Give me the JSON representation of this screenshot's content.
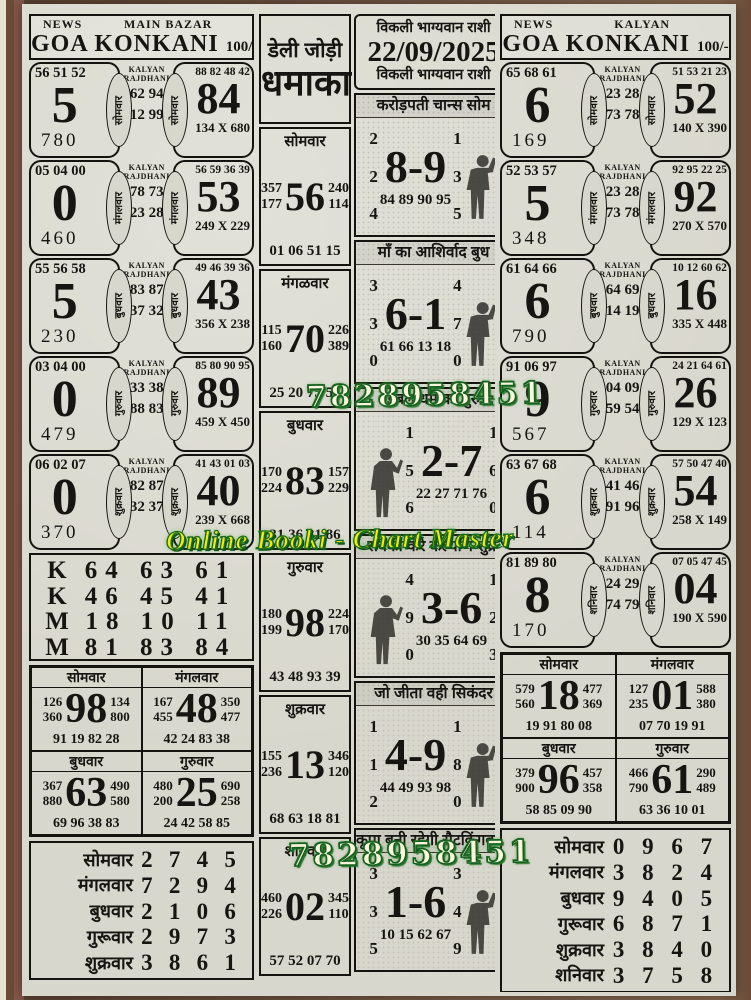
{
  "page": {
    "watermarks": {
      "phone": "7828958451",
      "brand": "Online Booki - Chart Master"
    },
    "left": {
      "header": {
        "news": "NEWS",
        "market": "MAIN BAZAR",
        "title": "GOA KONKANI",
        "price": "100/-"
      },
      "kalyan_label": "KALYAN RAJDHANI",
      "rows": [
        {
          "day": "सोमवार",
          "ltop": "56 51 52",
          "lbig": "5",
          "lbot": "780",
          "mid1": "62 94",
          "mid2": "12 99",
          "rtop": "88 82 48 42",
          "rbig": "84",
          "rbot": "134 X 680"
        },
        {
          "day": "मंगलवार",
          "ltop": "05 04 00",
          "lbig": "0",
          "lbot": "460",
          "mid1": "78 73",
          "mid2": "23 28",
          "rtop": "56 59 36 39",
          "rbig": "53",
          "rbot": "249 X 229"
        },
        {
          "day": "बुधवार",
          "ltop": "55 56 58",
          "lbig": "5",
          "lbot": "230",
          "mid1": "83 87",
          "mid2": "37 32",
          "rtop": "49 46 39 36",
          "rbig": "43",
          "rbot": "356 X 238"
        },
        {
          "day": "गुरुवार",
          "ltop": "03 04 00",
          "lbig": "0",
          "lbot": "479",
          "mid1": "33 38",
          "mid2": "88 83",
          "rtop": "85 80 90 95",
          "rbig": "89",
          "rbot": "459 X 450"
        },
        {
          "day": "शुक्रवार",
          "ltop": "06 02 07",
          "lbig": "0",
          "lbot": "370",
          "mid1": "82 87",
          "mid2": "32 37",
          "rtop": "41 43 01 03",
          "rbig": "40",
          "rbot": "239 X 668"
        }
      ],
      "km_lines": [
        {
          "label": "K",
          "nums": "64 63 61"
        },
        {
          "label": "K",
          "nums": "46 45 41"
        },
        {
          "label": "M",
          "nums": "18 10 11"
        },
        {
          "label": "M",
          "nums": "81 83 84"
        }
      ],
      "panels": [
        {
          "day": "सोमवार",
          "l1": "126",
          "l2": "360",
          "big": "98",
          "r1": "134",
          "r2": "800",
          "bottom": "91 19 82 28"
        },
        {
          "day": "मंगलवार",
          "l1": "167",
          "l2": "455",
          "big": "48",
          "r1": "350",
          "r2": "477",
          "bottom": "42 24 83 38"
        },
        {
          "day": "बुधवार",
          "l1": "367",
          "l2": "880",
          "big": "63",
          "r1": "490",
          "r2": "580",
          "bottom": "69 96 38 83"
        },
        {
          "day": "गुरुवार",
          "l1": "480",
          "l2": "200",
          "big": "25",
          "r1": "690",
          "r2": "258",
          "bottom": "24 42 58 85"
        }
      ],
      "table": [
        {
          "day": "सोमवार",
          "d1": "2",
          "d2": "7",
          "d3": "4",
          "d4": "5"
        },
        {
          "day": "मंगलवार",
          "d1": "7",
          "d2": "2",
          "d3": "9",
          "d4": "4"
        },
        {
          "day": "बुधवार",
          "d1": "2",
          "d2": "1",
          "d3": "0",
          "d4": "6"
        },
        {
          "day": "गुरूवार",
          "d1": "2",
          "d2": "9",
          "d3": "7",
          "d4": "3"
        },
        {
          "day": "शुक्रवार",
          "d1": "3",
          "d2": "8",
          "d3": "6",
          "d4": "1"
        }
      ]
    },
    "middle": {
      "jodi_line1": "डेली जोड़ी",
      "jodi_line2": "धमाका",
      "date_box": {
        "top": "विकली भाग्यवान राशी",
        "date": "22/09/2025",
        "bottom": "विकली भाग्यवान राशी"
      },
      "day_panels": [
        {
          "day": "सोमवार",
          "l1": "357",
          "l2": "177",
          "big": "56",
          "r1": "240",
          "r2": "114",
          "bottom": "01 06 51 15"
        },
        {
          "day": "मंगळवार",
          "l1": "115",
          "l2": "160",
          "big": "70",
          "r1": "226",
          "r2": "389",
          "bottom": "25 20 75 57"
        },
        {
          "day": "बुधवार",
          "l1": "170",
          "l2": "224",
          "big": "83",
          "r1": "157",
          "r2": "229",
          "bottom": "31 36 81 86"
        },
        {
          "day": "गुरुवार",
          "l1": "180",
          "l2": "199",
          "big": "98",
          "r1": "224",
          "r2": "170",
          "bottom": "43 48 93 39"
        },
        {
          "day": "शुक्रवार",
          "l1": "155",
          "l2": "236",
          "big": "13",
          "r1": "346",
          "r2": "120",
          "bottom": "68 63 18 81"
        },
        {
          "day": "शनिवार",
          "l1": "460",
          "l2": "226",
          "big": "02",
          "r1": "345",
          "r2": "110",
          "bottom": "57 52 07 70"
        }
      ],
      "pred_boxes": [
        {
          "title": "करोड़पती चान्स  सोम",
          "l1": "2",
          "l2": "2",
          "l3": "4",
          "big": "8-9",
          "r1": "1",
          "r2": "3",
          "r3": "5",
          "bottom": "84 89 90 95",
          "figure": "right"
        },
        {
          "title": "माँ का आशिर्वाद  बुध",
          "l1": "3",
          "l2": "3",
          "l3": "0",
          "big": "6-1",
          "r1": "4",
          "r2": "7",
          "r3": "0",
          "bottom": "61 66 13 18",
          "figure": "right"
        },
        {
          "title": "डबल धमाका  गुरु",
          "l1": "1",
          "l2": "5",
          "l3": "6",
          "big": "2-7",
          "r1": "1",
          "r2": "6",
          "r3": "0",
          "bottom": "22 27 71 76",
          "figure": "left"
        },
        {
          "title": "सबका करे कल्याण  शुक्र",
          "l1": "4",
          "l2": "9",
          "l3": "0",
          "big": "3-6",
          "r1": "1",
          "r2": "2",
          "r3": "3",
          "bottom": "30 35 64 69",
          "figure": "left"
        },
        {
          "title": "जो जीता वही सिकंदर",
          "l1": "1",
          "l2": "1",
          "l3": "2",
          "big": "4-9",
          "r1": "1",
          "r2": "8",
          "r3": "0",
          "bottom": "44 49 93 98",
          "figure": "right"
        },
        {
          "title": "कृपा बनी रहेगी सैटकिंगबाबा",
          "l1": "3",
          "l2": "3",
          "l3": "5",
          "big": "1-6",
          "r1": "3",
          "r2": "4",
          "r3": "9",
          "bottom": "10 15 62 67",
          "figure": "right"
        }
      ]
    },
    "right": {
      "header": {
        "news": "NEWS",
        "market": "KALYAN",
        "title": "GOA KONKANI",
        "price": "100/-"
      },
      "kalyan_label": "KALYAN RAJDHANI",
      "rows": [
        {
          "day": "सोमवार",
          "ltop": "65 68 61",
          "lbig": "6",
          "lbot": "169",
          "mid1": "23 28",
          "mid2": "73 78",
          "rtop": "51 53 21 23",
          "rbig": "52",
          "rbot": "140 X 390"
        },
        {
          "day": "मंगलवार",
          "ltop": "52 53 57",
          "lbig": "5",
          "lbot": "348",
          "mid1": "23 28",
          "mid2": "73 78",
          "rtop": "92 95 22 25",
          "rbig": "92",
          "rbot": "270 X 570"
        },
        {
          "day": "बुधवार",
          "ltop": "61 64 66",
          "lbig": "6",
          "lbot": "790",
          "mid1": "64 69",
          "mid2": "14 19",
          "rtop": "10 12 60 62",
          "rbig": "16",
          "rbot": "335 X 448"
        },
        {
          "day": "गुरुवार",
          "ltop": "91 06 97",
          "lbig": "9",
          "lbot": "567",
          "mid1": "04 09",
          "mid2": "59 54",
          "rtop": "24 21 64 61",
          "rbig": "26",
          "rbot": "129 X 123"
        },
        {
          "day": "शुक्रवार",
          "ltop": "63 67 68",
          "lbig": "6",
          "lbot": "114",
          "mid1": "41 46",
          "mid2": "91 96",
          "rtop": "57 50 47 40",
          "rbig": "54",
          "rbot": "258 X 149"
        },
        {
          "day": "शनिवार",
          "ltop": "81 89 80",
          "lbig": "8",
          "lbot": "170",
          "mid1": "24 29",
          "mid2": "74 79",
          "rtop": "07 05 47 45",
          "rbig": "04",
          "rbot": "190 X 590"
        }
      ],
      "panels": [
        {
          "day": "सोमवार",
          "l1": "579",
          "l2": "560",
          "big": "18",
          "r1": "477",
          "r2": "369",
          "bottom": "19 91 80 08"
        },
        {
          "day": "मंगलवार",
          "l1": "127",
          "l2": "235",
          "big": "01",
          "r1": "588",
          "r2": "380",
          "bottom": "07 70 19 91"
        },
        {
          "day": "बुधवार",
          "l1": "379",
          "l2": "900",
          "big": "96",
          "r1": "457",
          "r2": "358",
          "bottom": "58 85 09 90"
        },
        {
          "day": "गुरुवार",
          "l1": "466",
          "l2": "790",
          "big": "61",
          "r1": "290",
          "r2": "489",
          "bottom": "63 36 10 01"
        }
      ],
      "table": [
        {
          "day": "सोमवार",
          "d1": "0",
          "d2": "9",
          "d3": "6",
          "d4": "7"
        },
        {
          "day": "मंगलवार",
          "d1": "3",
          "d2": "8",
          "d3": "2",
          "d4": "4"
        },
        {
          "day": "बुधवार",
          "d1": "9",
          "d2": "4",
          "d3": "0",
          "d4": "5"
        },
        {
          "day": "गुरूवार",
          "d1": "6",
          "d2": "8",
          "d3": "7",
          "d4": "1"
        },
        {
          "day": "शुक्रवार",
          "d1": "3",
          "d2": "8",
          "d3": "4",
          "d4": "0"
        },
        {
          "day": "शनिवार",
          "d1": "3",
          "d2": "7",
          "d3": "5",
          "d4": "8"
        }
      ]
    }
  }
}
